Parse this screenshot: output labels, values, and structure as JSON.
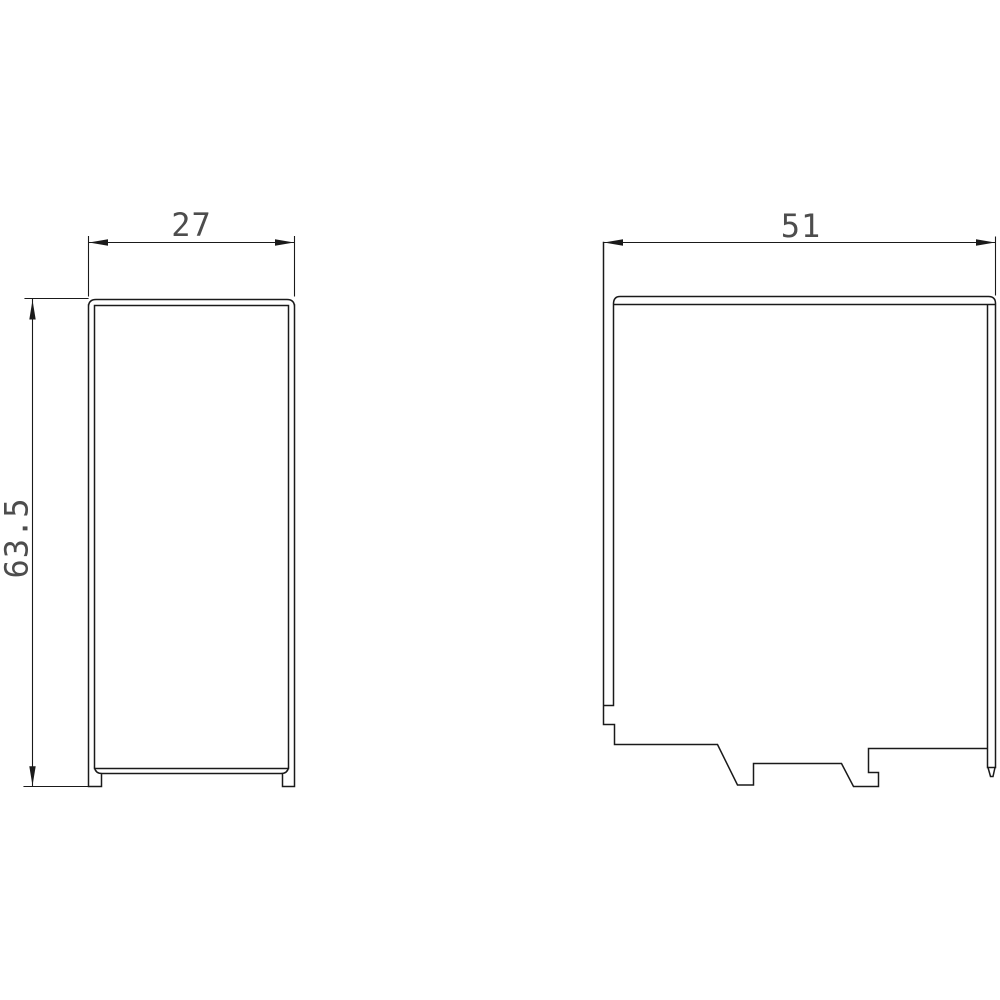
{
  "drawing": {
    "background_color": "#ffffff",
    "line_color": "#1a1a1a",
    "text_color": "#4d4d4d",
    "front_view": {
      "width_label": "27",
      "height_label": "63.5"
    },
    "side_view": {
      "depth_label": "51"
    }
  }
}
